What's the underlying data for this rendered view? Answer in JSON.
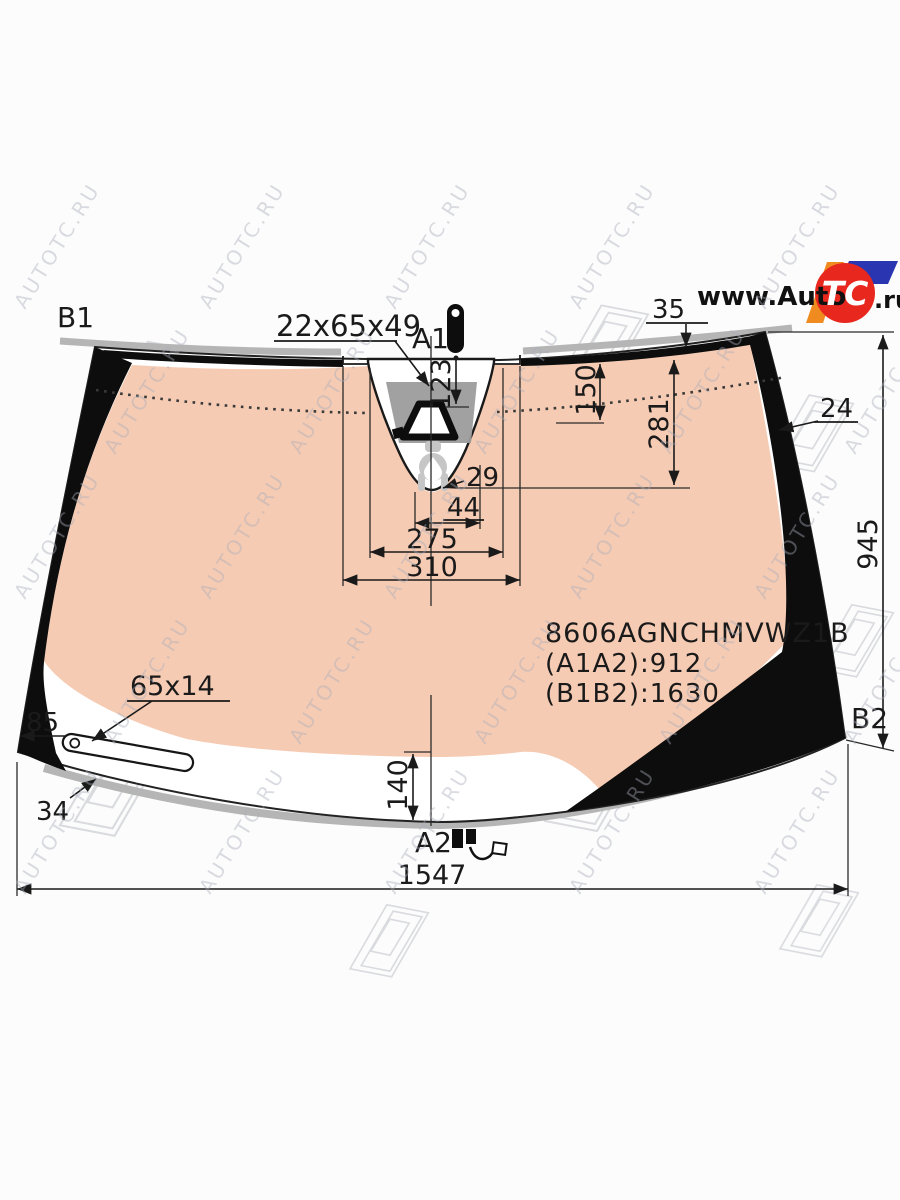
{
  "watermark": {
    "text": "AUTOTC.RU"
  },
  "logo": {
    "prefix": "www.Auto",
    "badge": "TC",
    "suffix": ".ru",
    "red": "#e8281e",
    "orange": "#f08b1f",
    "blue": "#2a36b1"
  },
  "glass": {
    "tint": "#f6cbb3",
    "frit": "#0d0d0d",
    "molding": "#b5b5b5",
    "bracket_gray": "#9c9c9c",
    "sensor_gray": "#c6c6c6"
  },
  "corner_labels": {
    "b1": "B1",
    "a1": "A1",
    "a2": "A2",
    "b2": "B2"
  },
  "dims": {
    "bracket": "22x65x49",
    "top_gap": "35",
    "cam_offset": "123",
    "shade_band": "150",
    "frit_drop": "281",
    "right_band": "24",
    "sensor_gap": "29",
    "sensor_w": "44",
    "cutout_w": "275",
    "recess_w": "310",
    "side_h": "945",
    "sticker": "65x14",
    "sticker_off": "85",
    "molding_w": "34",
    "bottom_band": "140",
    "total_w": "1547"
  },
  "part": {
    "code": "8606AGNCHMVWZ1B",
    "a_dist": "(A1A2):912",
    "b_dist": "(B1B2):1630"
  }
}
